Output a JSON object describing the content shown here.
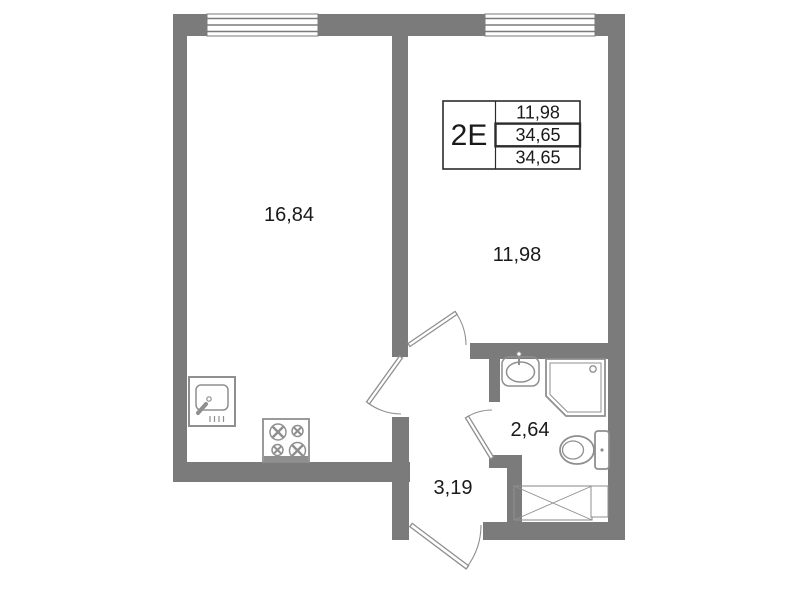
{
  "unit_card": {
    "type_label": "2E",
    "area_rows": [
      "11,98",
      "34,65",
      "34,65"
    ]
  },
  "rooms": {
    "living_kitchen": {
      "area": "16,84"
    },
    "bedroom": {
      "area": "11,98"
    },
    "bathroom": {
      "area": "2,64"
    },
    "hallway": {
      "area": "3,19"
    }
  },
  "colors": {
    "wall": "#7b7b7b",
    "line": "#8f8f8f",
    "text": "#1a1a1a",
    "table_border": "#2b2b2b",
    "background": "#ffffff"
  }
}
